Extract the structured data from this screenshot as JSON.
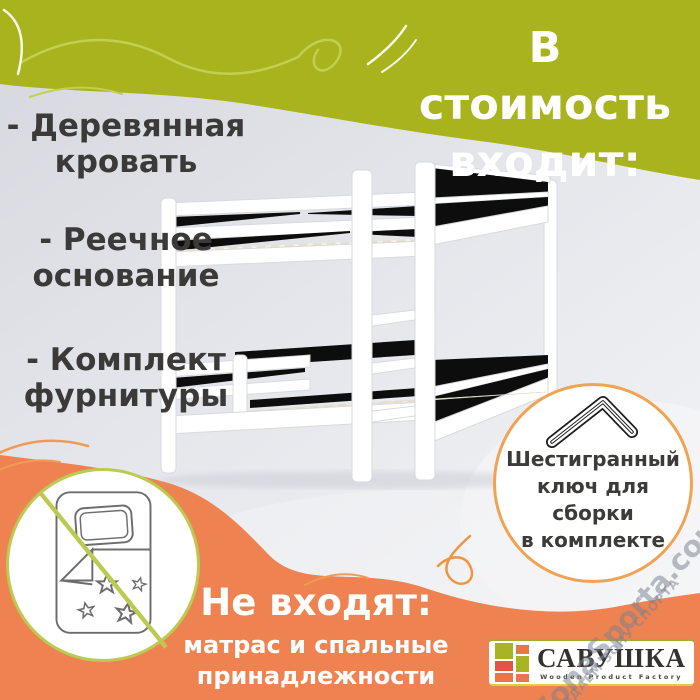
{
  "header": {
    "title_line1": "В стоимость",
    "title_line2": "входит:"
  },
  "included_list": {
    "items": [
      {
        "line1": "- Деревянная",
        "line2": "кровать"
      },
      {
        "line1": "- Реечное",
        "line2": "основание"
      },
      {
        "line1": "- Комплект",
        "line2": "фурнитуры"
      }
    ]
  },
  "hex_key_badge": {
    "icon": "allen-key-icon",
    "lines": [
      "Шестигранный",
      "ключ для",
      "сборки",
      "в комплекте"
    ],
    "border_color": "#f0a353"
  },
  "excluded": {
    "icon": "no-bedding-icon",
    "title": "Не входят:",
    "line1": "матрас и спальные",
    "line2": "принадлежности"
  },
  "brand_logo": {
    "name": "САВУШКА",
    "tagline": "Wooden Product Factory",
    "colors": {
      "green": "#a9b425",
      "red": "#df5742",
      "orange": "#e8764a"
    }
  },
  "watermark": {
    "main": "ZonaSporta.com",
    "sub": "СОЗДАЕМ ЗОНУ СПОРТА"
  },
  "palette": {
    "green_band": "#a8b31e",
    "orange_band": "#ee8351",
    "background_gray": "#e3e5ea",
    "text_dark": "#3b3a38",
    "text_white": "#ffffff",
    "no_sign_green": "#bcca52",
    "badge_border_orange": "#f0a353",
    "watermark_gray": "#7d8490"
  }
}
